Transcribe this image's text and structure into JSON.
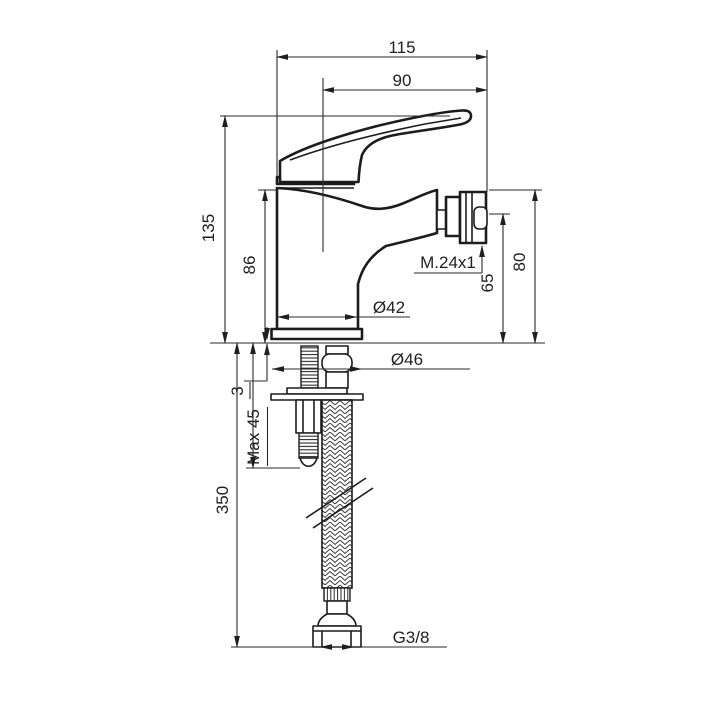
{
  "drawing": {
    "dimensions": {
      "width_total": "115",
      "width_handle": "90",
      "height_total": "135",
      "height_body": "86",
      "thread_aerator": "M.24x1",
      "height_spout": "65",
      "height_aerator": "80",
      "dia_body": "Ø42",
      "dia_base": "Ø46",
      "gasket_thickness": "3",
      "deck_thickness_max": "Max 45",
      "hose_length": "350",
      "thread_connection": "G3/8"
    }
  }
}
